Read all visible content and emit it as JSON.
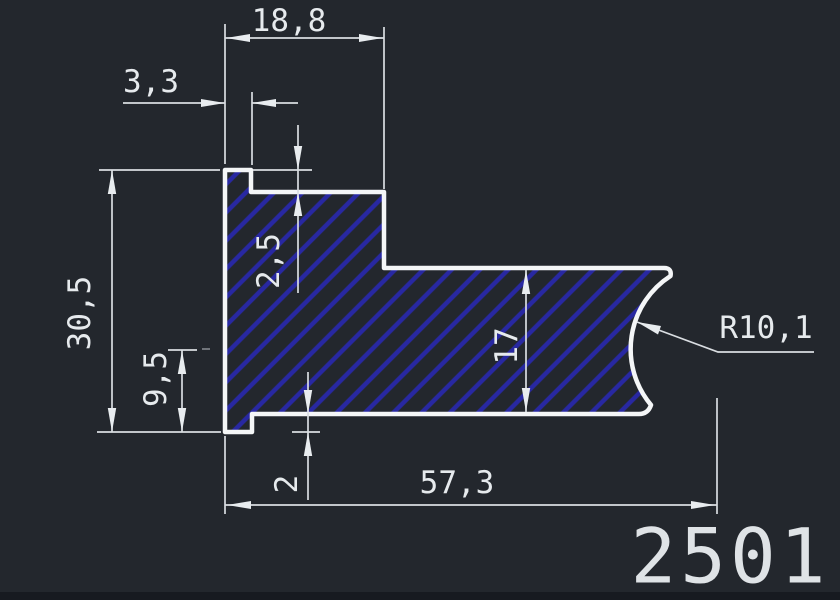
{
  "part_number": "2501",
  "dimensions": {
    "top_width": "18,8",
    "notch_width": "3,3",
    "notch_depth": "2,5",
    "overall_height": "30,5",
    "lower_height": "9,5",
    "arm_height": "17",
    "lip_height": "2",
    "overall_width": "57,3",
    "radius": "R10,1"
  },
  "colors": {
    "background": "#23272d",
    "outline": "#f4f6f7",
    "dimension_lines": "#d9dde1",
    "dimension_text": "#e6eaed",
    "hatch": "#2828a2",
    "bottom_strip": "#171a20"
  }
}
